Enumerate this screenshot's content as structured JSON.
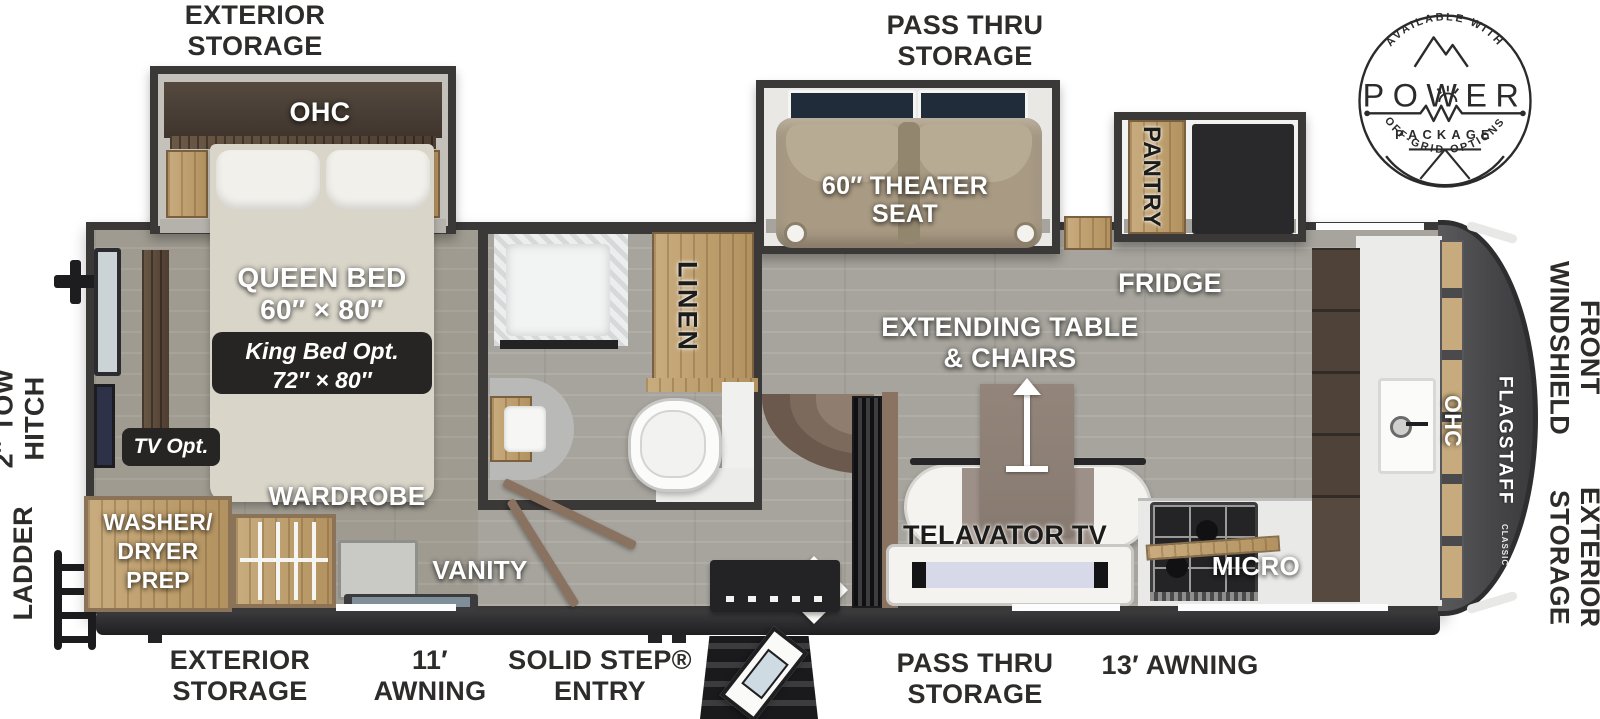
{
  "title": "Fifth wheel travel trailer floor plan",
  "badge": {
    "available": "AVAILABLE WITH",
    "power": "POWER",
    "package": "PACKAGE",
    "offgrid": "OFF-GRID OPTIONS"
  },
  "top_labels": {
    "exterior_storage": "EXTERIOR\nSTORAGE",
    "pass_thru": "PASS THRU\nSTORAGE"
  },
  "left_labels": {
    "tow_hitch": "2″ TOW\nHITCH",
    "ladder": "LADDER"
  },
  "right_labels": {
    "front_windshield": "FRONT\nWINDSHIELD",
    "exterior_storage": "EXTERIOR\nSTORAGE"
  },
  "bottom_labels": {
    "exterior_storage": "EXTERIOR\nSTORAGE",
    "awning_11": "11′\nAWNING",
    "solid_step": "SOLID STEP®\nENTRY",
    "pass_thru": "PASS THRU\nSTORAGE",
    "awning_13": "13′ AWNING"
  },
  "bedroom": {
    "ohc": "OHC",
    "queen_bed": "QUEEN BED\n60″ × 80″",
    "king_opt": "King Bed Opt.\n72″ × 80″",
    "tv_opt": "TV Opt.",
    "wardrobe": "WARDROBE",
    "washer_dryer": "WASHER/\nDRYER\nPREP",
    "vanity": "VANITY"
  },
  "bathroom": {
    "linen": "LINEN"
  },
  "living": {
    "theater_seat": "60″ THEATER\nSEAT",
    "pantry": "PANTRY",
    "fridge": "FRIDGE",
    "extending_table": "EXTENDING TABLE\n& CHAIRS",
    "telavator_tv": "TELAVATOR TV"
  },
  "kitchen": {
    "micro": "MICRO",
    "ohc": "OHC"
  },
  "front_cap": {
    "brand": "FLAGSTAFF",
    "series": "CLASSIC"
  },
  "colors": {
    "wall": "#3a3938",
    "floor": "#a6a49c",
    "wood": "#c9ac7e",
    "mattress": "#d9d5c9",
    "theater_seat": "#a89a83",
    "label_dark": "#2d2c2b",
    "cap_gray": "#515154"
  }
}
